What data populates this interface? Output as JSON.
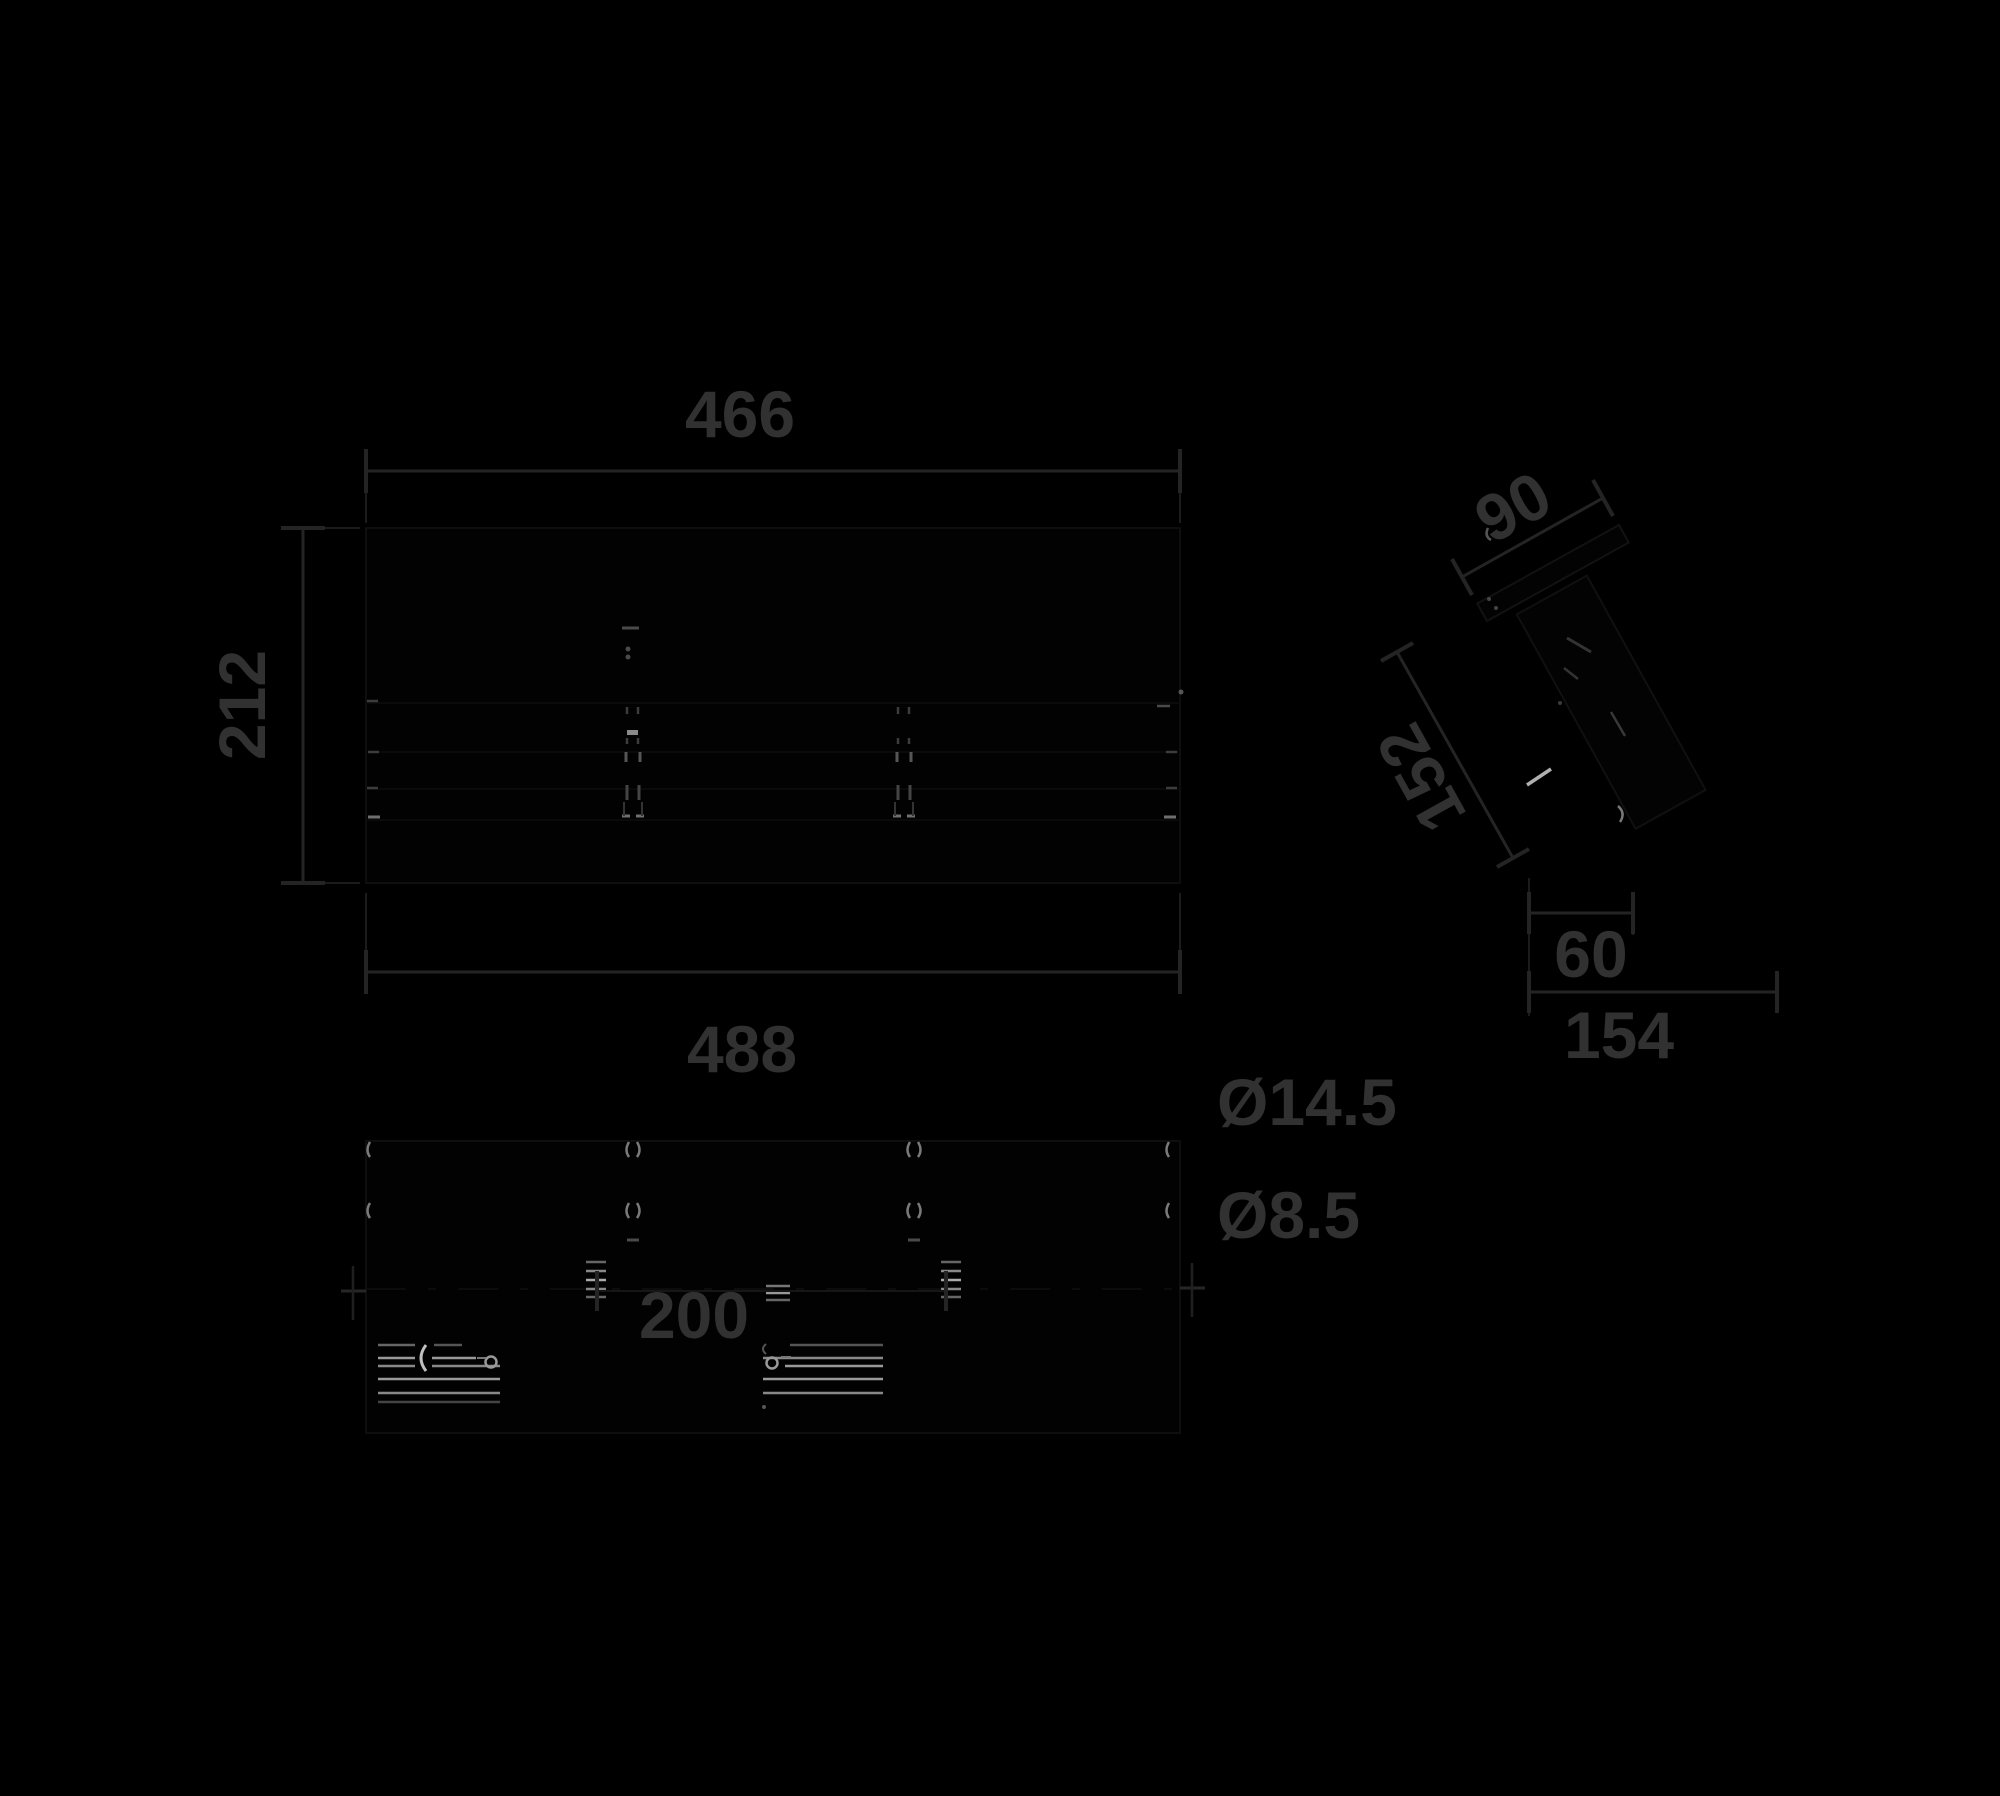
{
  "drawing": {
    "kind": "technical-dimension-drawing",
    "background": "#000000",
    "views": [
      "front",
      "bottom",
      "side-angled"
    ]
  },
  "dims": {
    "front_width": "466",
    "front_height": "212",
    "overall_width": "488",
    "mount_spacing": "200",
    "bracket_width": "90",
    "arm_length": "152",
    "wall_offset": "60",
    "overall_depth": "154",
    "hole_large": "Ø14.5",
    "hole_small": "Ø8.5"
  },
  "colors": {
    "background": "#000000",
    "dimension_line": "#242424",
    "dimension_text": "#313131",
    "outline_faint": "#0e0e0e",
    "detail_gray": "#6f6f6f",
    "detail_bright": "#b5b5b5"
  }
}
